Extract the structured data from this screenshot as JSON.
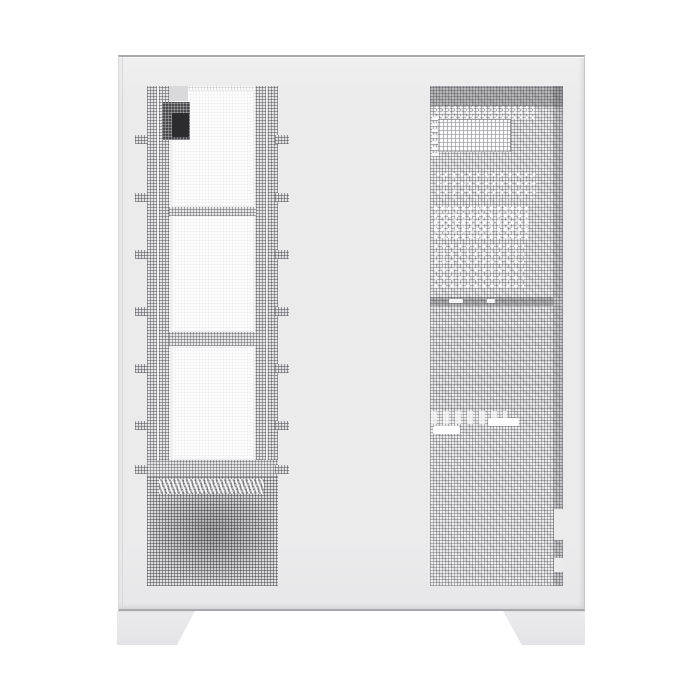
{
  "scene": {
    "title": "Product photo of a white mid-tower PC case with perforated mesh panels, viewed side-on against a white background"
  },
  "case": {
    "label": "White mesh PC tower case",
    "finish": "matte white",
    "left_panel": {
      "label": "Fan / radiator mounting rail column",
      "fan_cutouts": 3,
      "mounting_tabs_per_side": 7,
      "features": [
        "top connector module",
        "diagonal PSU vent grille",
        "dark PSU mesh block"
      ]
    },
    "right_panel": {
      "label": "Full-height perforated mesh panel",
      "features": [
        "perforated I/O block",
        "white dot clusters of internal components",
        "two white cable slots",
        "edge latch notches"
      ]
    },
    "feet": {
      "count": 2,
      "shape": "trapezoid"
    }
  },
  "colors": {
    "bg": "#ffffff",
    "body": "#ebebec",
    "body-top": "#f0f0f1",
    "body-edge": "#a9a9ad",
    "seam": "#d8d8db",
    "mesh-light-bg": "#fafafa",
    "psu-bg": "#e2e2e4",
    "cutout": "#fdfdfe",
    "component": "#4a4a4e",
    "component-core": "#2c2c2f",
    "tab-gray": "#d9d9dc",
    "slot": "#ffffff",
    "foot": "#e9e9eb"
  }
}
